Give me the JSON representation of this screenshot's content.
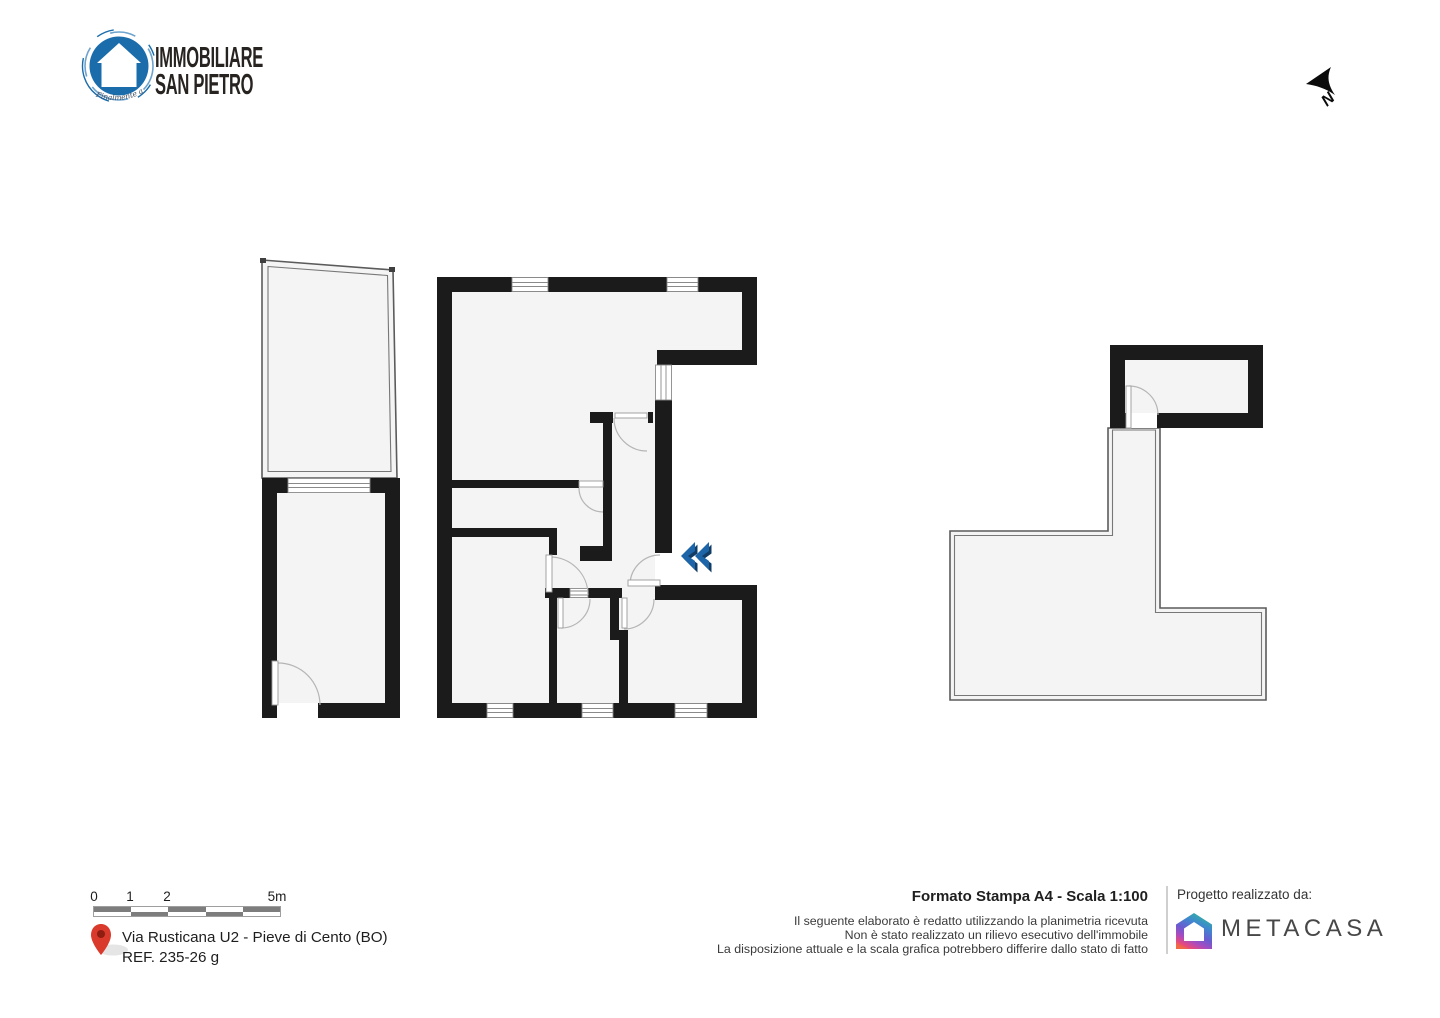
{
  "branding": {
    "logo_line1": "IMMOBILIARE",
    "logo_line2": "SAN PIETRO",
    "logo_tagline": "Finalmente a Casa"
  },
  "compass": {
    "north_label": "N"
  },
  "scalebar": {
    "labels": [
      "0",
      "1",
      "2",
      "5m"
    ]
  },
  "address": {
    "line1": "Via Rusticana U2 - Pieve di Cento (BO)",
    "line2": "REF. 235-26 g"
  },
  "print_info": {
    "title": "Formato Stampa A4 - Scala 1:100",
    "disclaimer_lines": [
      "Il seguente elaborato è redatto utilizzando la planimetria ricevuta",
      "Non è stato realizzato un rilievo esecutivo dell'immobile",
      "La disposizione attuale e la scala grafica potrebbero differire dallo stato di fatto"
    ]
  },
  "credit": {
    "label": "Progetto realizzato da:",
    "brand": "METACASA"
  },
  "colors": {
    "wall_black": "#1b1b1b",
    "floor_fill": "#f4f4f5",
    "thin_wall_gray": "#5b5b5b",
    "window_line": "#8a8a8a",
    "door_arc": "#b5b5b5",
    "logo_blue": "#1a6cab",
    "chevron_blue": "#1c65a9",
    "chevron_shadow": "#123c63",
    "pin_red": "#d93a2b",
    "scalebar_dark": "#7d7d7d"
  }
}
